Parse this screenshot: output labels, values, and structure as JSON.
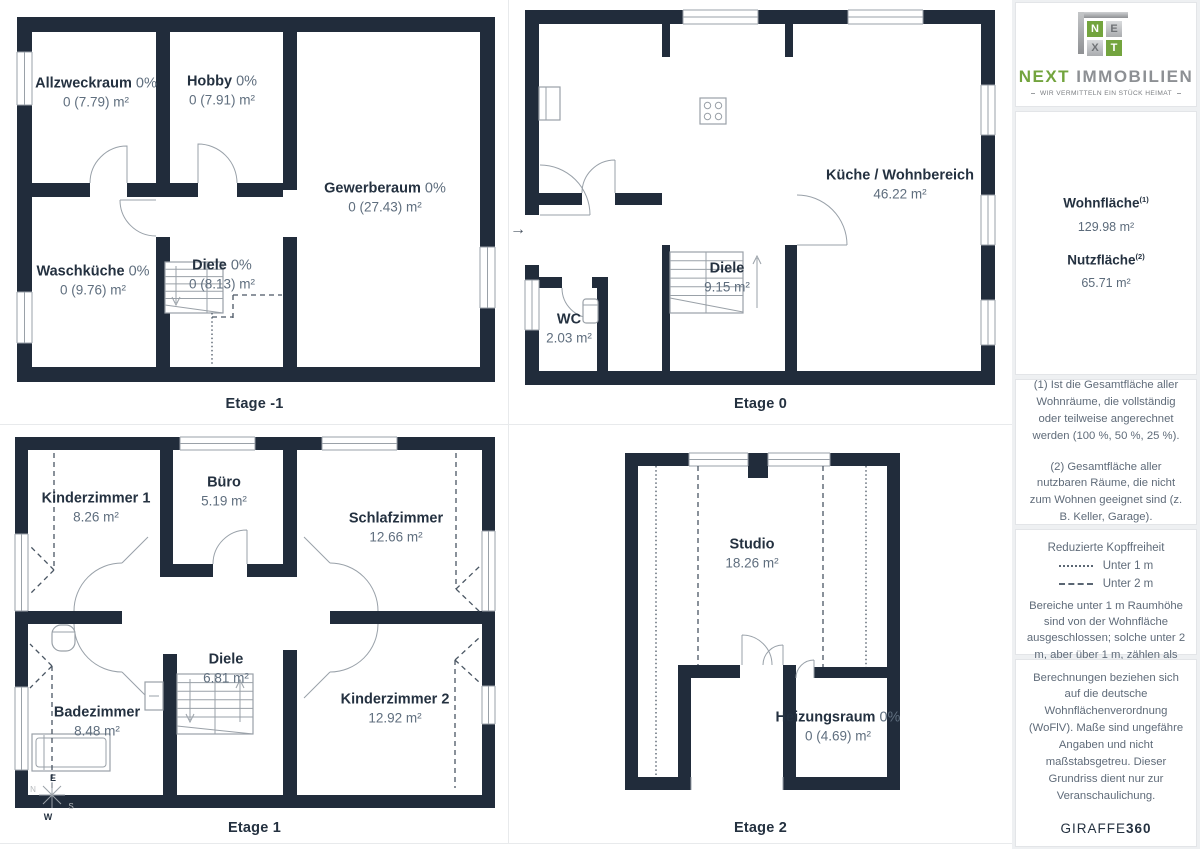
{
  "colors": {
    "wall": "#212c3b",
    "logo_green": "#73a43e",
    "logo_silver": "#9a9da1",
    "muted_text": "#5f6e7e"
  },
  "floors": [
    {
      "label": "Etage -1",
      "rooms": [
        {
          "name": "Allzweckraum",
          "pct": "0%",
          "area": "0 (7.79) m²"
        },
        {
          "name": "Hobby",
          "pct": "0%",
          "area": "0 (7.91) m²"
        },
        {
          "name": "Gewerberaum",
          "pct": "0%",
          "area": "0 (27.43) m²"
        },
        {
          "name": "Waschküche",
          "pct": "0%",
          "area": "0 (9.76) m²"
        },
        {
          "name": "Diele",
          "pct": "0%",
          "area": "0 (8.13) m²"
        }
      ]
    },
    {
      "label": "Etage 0",
      "entry_arrow": "→",
      "rooms": [
        {
          "name": "Küche / Wohnbereich",
          "area": "46.22 m²"
        },
        {
          "name": "Diele",
          "area": "9.15 m²"
        },
        {
          "name": "WC",
          "area": "2.03 m²"
        }
      ]
    },
    {
      "label": "Etage 1",
      "rooms": [
        {
          "name": "Kinderzimmer 1",
          "area": "8.26 m²"
        },
        {
          "name": "Büro",
          "area": "5.19 m²"
        },
        {
          "name": "Schlafzimmer",
          "area": "12.66 m²"
        },
        {
          "name": "Diele",
          "area": "6.81 m²"
        },
        {
          "name": "Badezimmer",
          "area": "8.48 m²"
        },
        {
          "name": "Kinderzimmer 2",
          "area": "12.92 m²"
        }
      ]
    },
    {
      "label": "Etage 2",
      "rooms": [
        {
          "name": "Studio",
          "area": "18.26 m²"
        },
        {
          "name": "Heizungsraum",
          "pct": "0%",
          "area": "0 (4.69) m²"
        }
      ]
    }
  ],
  "compass": {
    "n": "N",
    "e": "E",
    "s": "S",
    "w": "W"
  },
  "sidebar": {
    "logo": {
      "letters": [
        "N",
        "E",
        "X",
        "T"
      ],
      "brand_green": "NEXT",
      "brand_gray": "IMMOBILIEN",
      "tagline": "WIR VERMITTELN EIN STÜCK HEIMAT"
    },
    "areas": [
      {
        "label": "Wohnfläche",
        "sup": "(1)",
        "value": "129.98 m²"
      },
      {
        "label": "Nutzfläche",
        "sup": "(2)",
        "value": "65.71 m²"
      }
    ],
    "footnotes": [
      "(1) Ist die Gesamtfläche aller Wohnräume, die vollständig oder teilweise angerechnet werden (100 %, 50 %, 25 %).",
      "(2) Gesamtfläche aller nutzbaren Räume, die nicht zum Wohnen geeignet sind (z. B. Keller, Garage)."
    ],
    "legend": {
      "title": "Reduzierte Kopffreiheit",
      "items": [
        {
          "label": "Unter 1 m"
        },
        {
          "label": "Unter 2 m"
        }
      ],
      "body": "Bereiche unter 1 m Raumhöhe sind von der Wohnfläche ausgeschlossen; solche unter 2 m, aber über 1 m, zählen als 50% der Wohnfläche"
    },
    "disclaimer": "Berechnungen beziehen sich auf die deutsche Wohnflächenverordnung (WoFlV). Maße sind ungefähre Angaben und nicht maßstabsgetreu. Dieser Grundriss dient nur zur Veranschaulichung.",
    "brand_footer": {
      "name": "GIRAFFE",
      "suffix": "360"
    }
  }
}
